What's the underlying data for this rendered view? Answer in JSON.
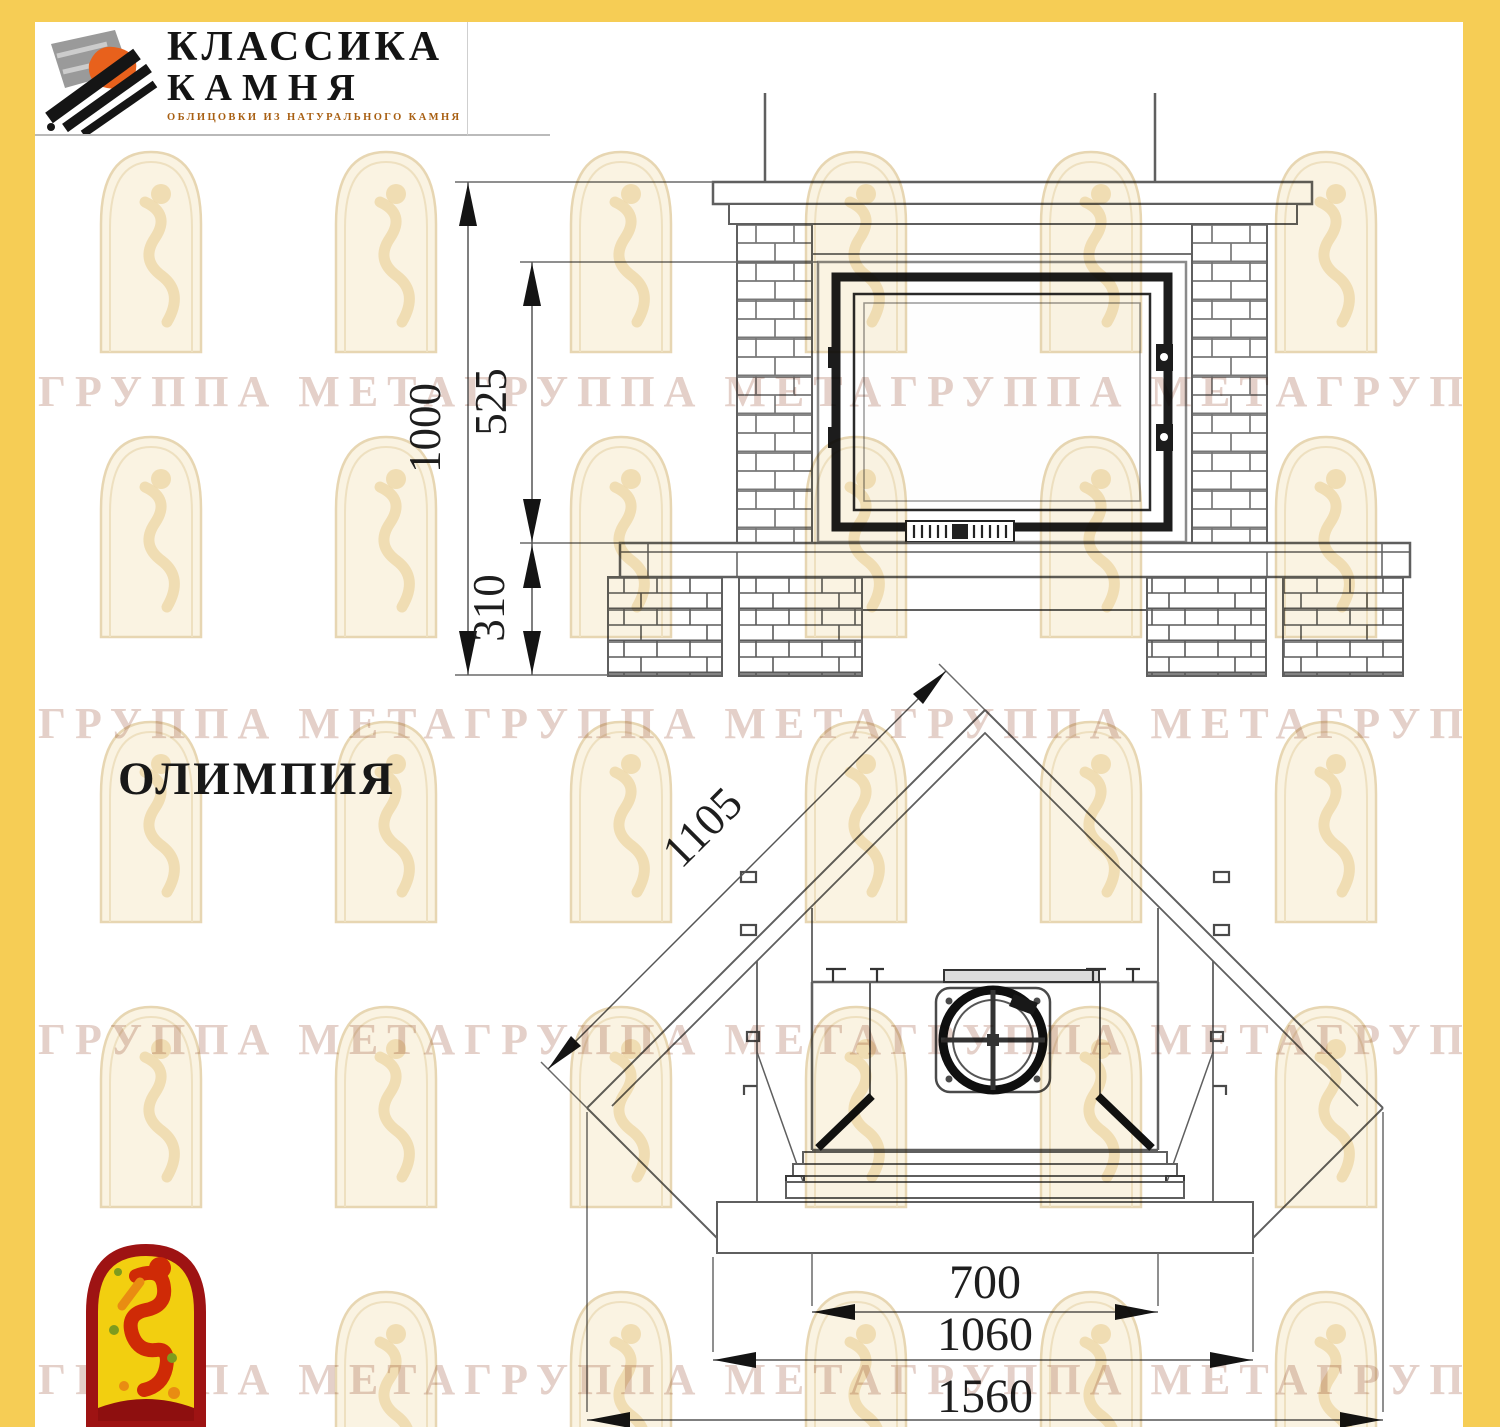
{
  "page": {
    "background": "#ffffff",
    "frame_color": "#f6cd55"
  },
  "header": {
    "logo": {
      "line1": "КЛАССИКА",
      "line2": "КАМНЯ",
      "tagline": "ОБЛИЦОВКИ ИЗ НАТУРАЛЬНОГО КАМНЯ",
      "ink_color": "#141414",
      "tagline_color": "#a85f12",
      "stone_gray": "#9a9a9a",
      "accent_orange": "#e8611c"
    }
  },
  "watermark": {
    "text": "ГРУППА МЕТАГРУППА МЕТАГРУППА МЕТАГРУППА МЕТАГРУППА МЕТА",
    "color": "#c9a294"
  },
  "drawing": {
    "model_name": "ОЛИМПИЯ",
    "line_color": "#5f5f5f",
    "ink_color": "#1c1c1c",
    "front_view": {
      "height_total_mm": "1000",
      "opening_height_mm": "525",
      "base_height_mm": "310"
    },
    "plan_view": {
      "side_depth_mm": "1105",
      "opening_width_mm": "700",
      "body_width_mm": "1060",
      "total_width_mm": "1560"
    }
  },
  "footer_logo": {
    "border_color": "#9e1313",
    "fill_color": "#f2cf10",
    "figure_color": "#cf2a06"
  }
}
